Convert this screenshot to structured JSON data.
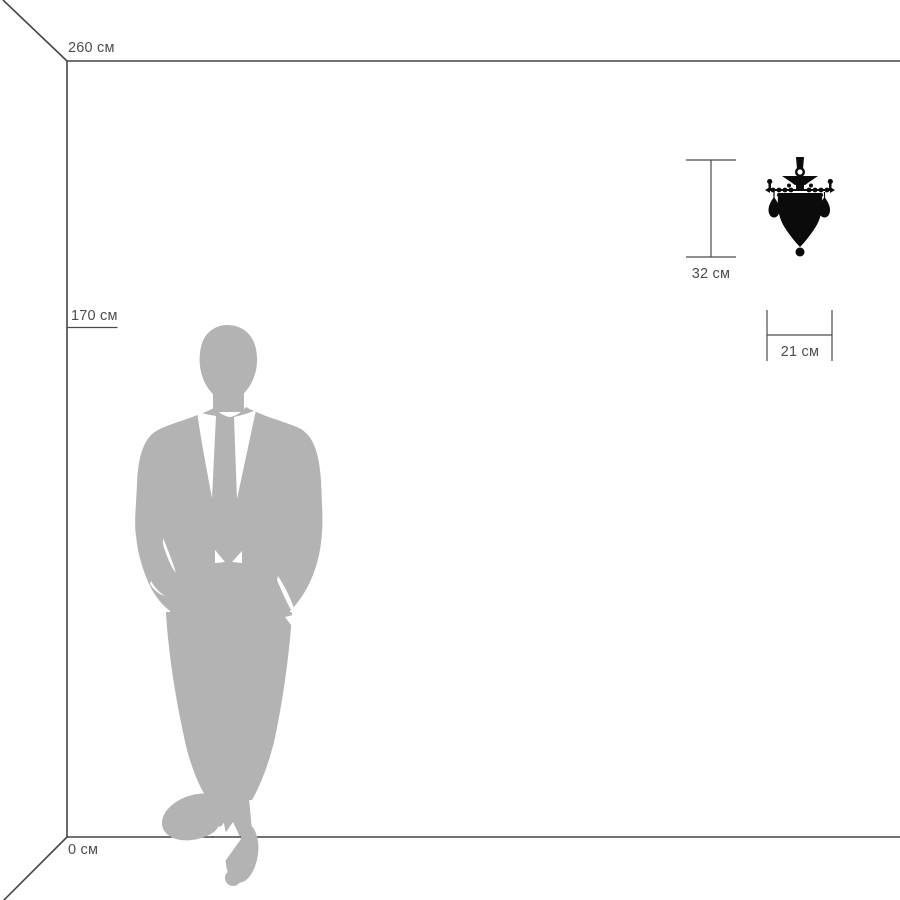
{
  "scene": {
    "background": "#ffffff",
    "room": {
      "wall_height_label": "260 см",
      "person_height_label": "170 см",
      "floor_label": "0 см"
    },
    "fixture": {
      "height_label": "32 см",
      "width_label": "21 см",
      "icon": "wall-sconce-silhouette",
      "color": "#0b0b0b"
    },
    "person": {
      "icon": "businessman-silhouette",
      "color": "#b3b3b3"
    },
    "colors": {
      "room_line": "#454545",
      "dimension_line": "#4a4a4a",
      "label_text": "#4d4d4d",
      "shirt_white": "#ffffff"
    }
  }
}
